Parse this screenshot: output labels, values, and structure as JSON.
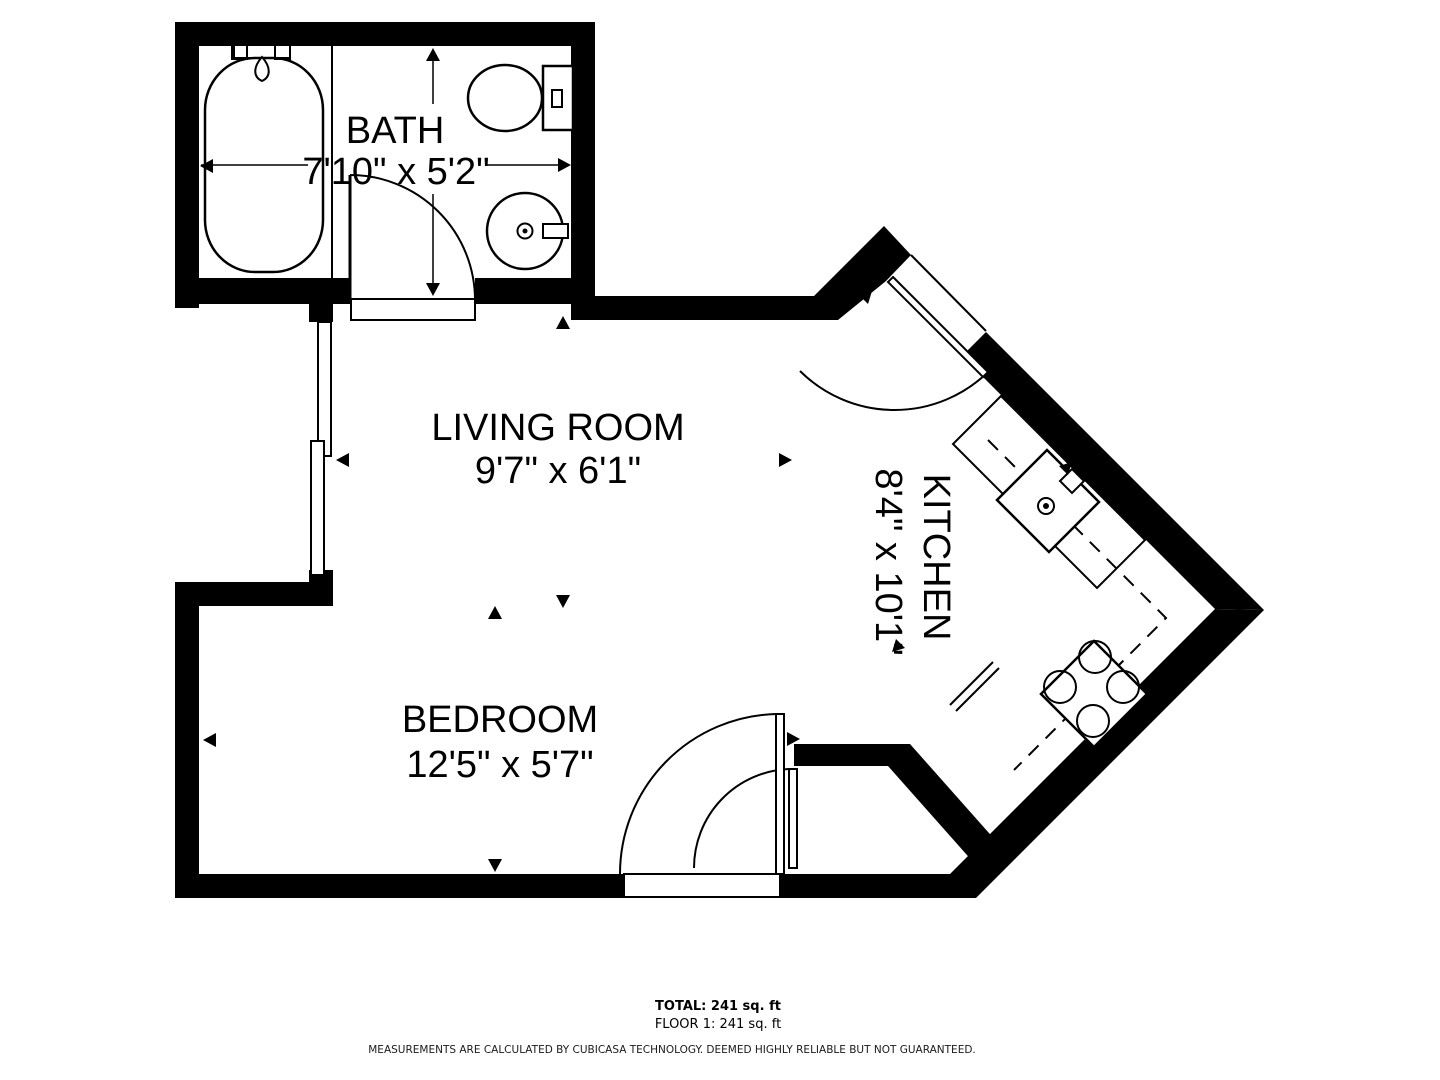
{
  "floor_plan": {
    "rooms": [
      {
        "id": "bath",
        "name": "BATH",
        "dimensions": "7'10\" x 5'2\""
      },
      {
        "id": "living",
        "name": "LIVING ROOM",
        "dimensions": "9'7\" x 6'1\""
      },
      {
        "id": "kitchen",
        "name": "KITCHEN",
        "dimensions": "8'4\" x 10'1\""
      },
      {
        "id": "bedroom",
        "name": "BEDROOM",
        "dimensions": "12'5\" x 5'7\""
      }
    ],
    "fixtures": [
      "bathtub",
      "toilet",
      "bathroom-sink",
      "kitchen-sink",
      "stove-4-burners"
    ],
    "footer": {
      "total": "TOTAL: 241 sq. ft",
      "floor": "FLOOR 1: 241 sq. ft",
      "disclaimer": "MEASUREMENTS ARE CALCULATED BY CUBICASA TECHNOLOGY. DEEMED HIGHLY RELIABLE BUT NOT GUARANTEED."
    },
    "colors": {
      "wall": "#000000",
      "background": "#ffffff"
    }
  }
}
